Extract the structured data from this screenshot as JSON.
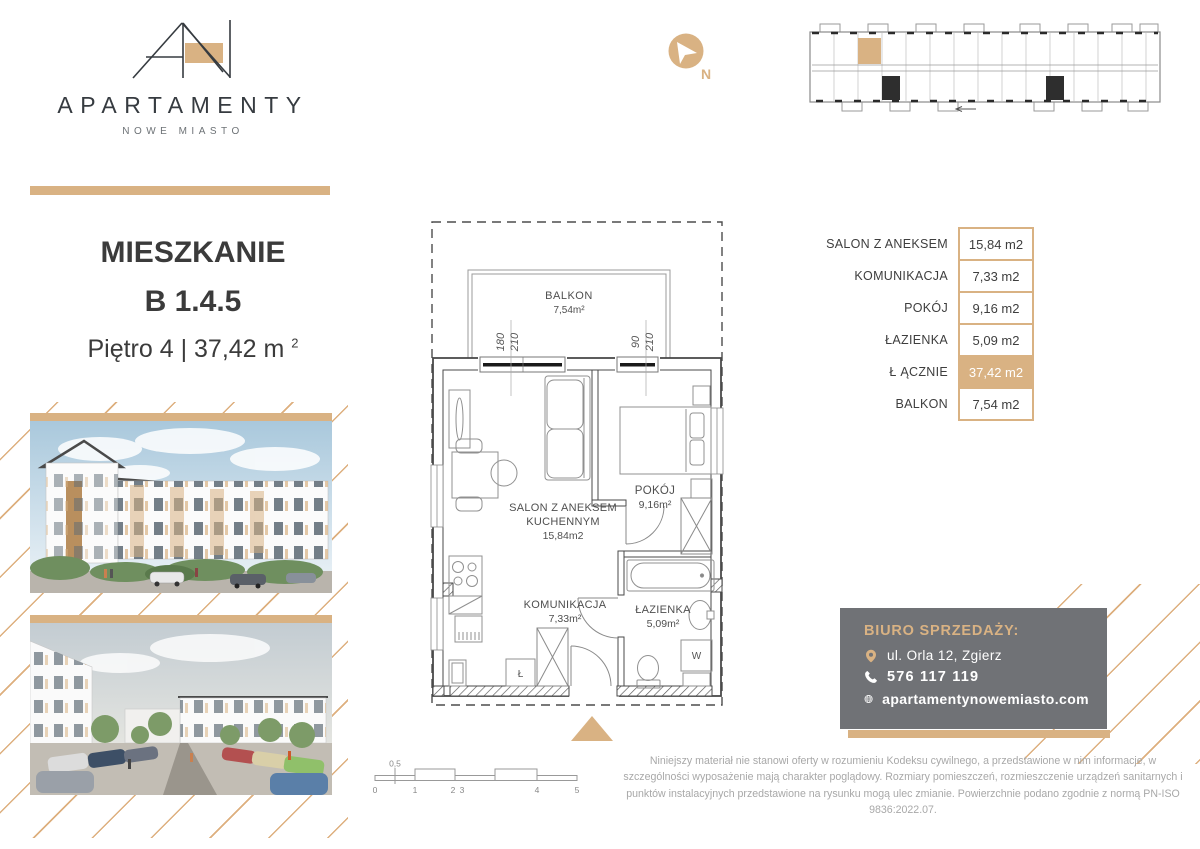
{
  "colors": {
    "accent": "#d9b283",
    "dark_text": "#3b3b3b",
    "contact_bg": "#707276",
    "muted": "#a8a8a8"
  },
  "brand": {
    "wordmark": "APARTAMENTY",
    "subtitle": "NOWE MIASTO"
  },
  "unit": {
    "type_label": "MIESZKANIE",
    "number": "B 1.4.5",
    "floor_area": "Piętro 4 | 37,42 m",
    "area_sup": "2"
  },
  "compass": {
    "north": "N"
  },
  "area_table": {
    "rows": [
      {
        "label": "SALON Z ANEKSEM",
        "value": "15,84 m2"
      },
      {
        "label": "KOMUNIKACJA",
        "value": "7,33 m2"
      },
      {
        "label": "POKÓJ",
        "value": "9,16 m2"
      },
      {
        "label": "ŁAZIENKA",
        "value": "5,09 m2"
      },
      {
        "label": "Ł ĄCZNIE",
        "value": "37,42 m2"
      },
      {
        "label": "BALKON",
        "value": "7,54 m2"
      }
    ]
  },
  "plan": {
    "balkon": {
      "label": "BALKON",
      "area": "7,54m²"
    },
    "salon": {
      "line1": "SALON Z ANEKSEM",
      "line2": "KUCHENNYM",
      "area": "15,84m2"
    },
    "pokoj": {
      "label": "POKÓJ",
      "area": "9,16m²"
    },
    "komunikacja": {
      "label": "KOMUNIKACJA",
      "area": "7,33m²"
    },
    "lazienka": {
      "label": "ŁAZIENKA",
      "area": "5,09m²"
    },
    "window1": {
      "width": "180",
      "height": "210"
    },
    "window2": {
      "width": "90",
      "height": "210"
    },
    "washer": "W",
    "fridge": "Ł"
  },
  "scale_bar": {
    "labels": [
      "0",
      "0,5",
      "1",
      "2",
      "3",
      "4",
      "5"
    ]
  },
  "contact": {
    "title": "BIURO SPRZEDAŻY:",
    "address": "ul. Orla 12, Zgierz",
    "phone": "576 117 119",
    "website": "apartamentynowemiasto.com"
  },
  "disclaimer": "Niniejszy materiał nie stanowi oferty w rozumieniu Kodeksu cywilnego, a przedstawione w nim informacje, w szczególności wyposażenie mają charakter poglądowy. Rozmiary pomieszczeń, rozmieszczenie urządzeń sanitarnych i punktów instalacyjnych przedstawione na rysunku mogą ulec zmianie. Powierzchnie podano zgodnie z normą PN-ISO 9836:2022.07."
}
